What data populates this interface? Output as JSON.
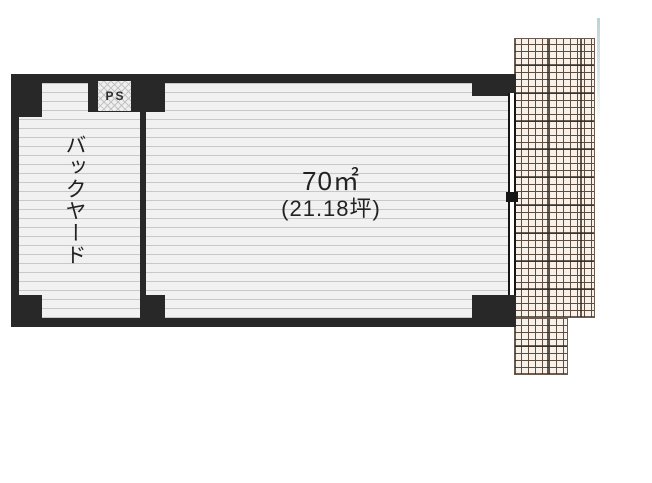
{
  "floor_plan": {
    "ps_label": "PS",
    "backyard_label": "バックヤード",
    "main_room": {
      "area_m2": "70㎡",
      "area_tsubo": "(21.18坪)"
    },
    "colors": {
      "wall": "#282828",
      "room_fill": "#f1f1f1",
      "room_line": "#c8c8c8",
      "hatch_area_fill": "#f8f1ea",
      "hatch_area_line": "#5d4d41",
      "ps_hatch_line": "#c2c2c2",
      "text": "#222222",
      "artifact_line": "#b9d3da"
    }
  }
}
